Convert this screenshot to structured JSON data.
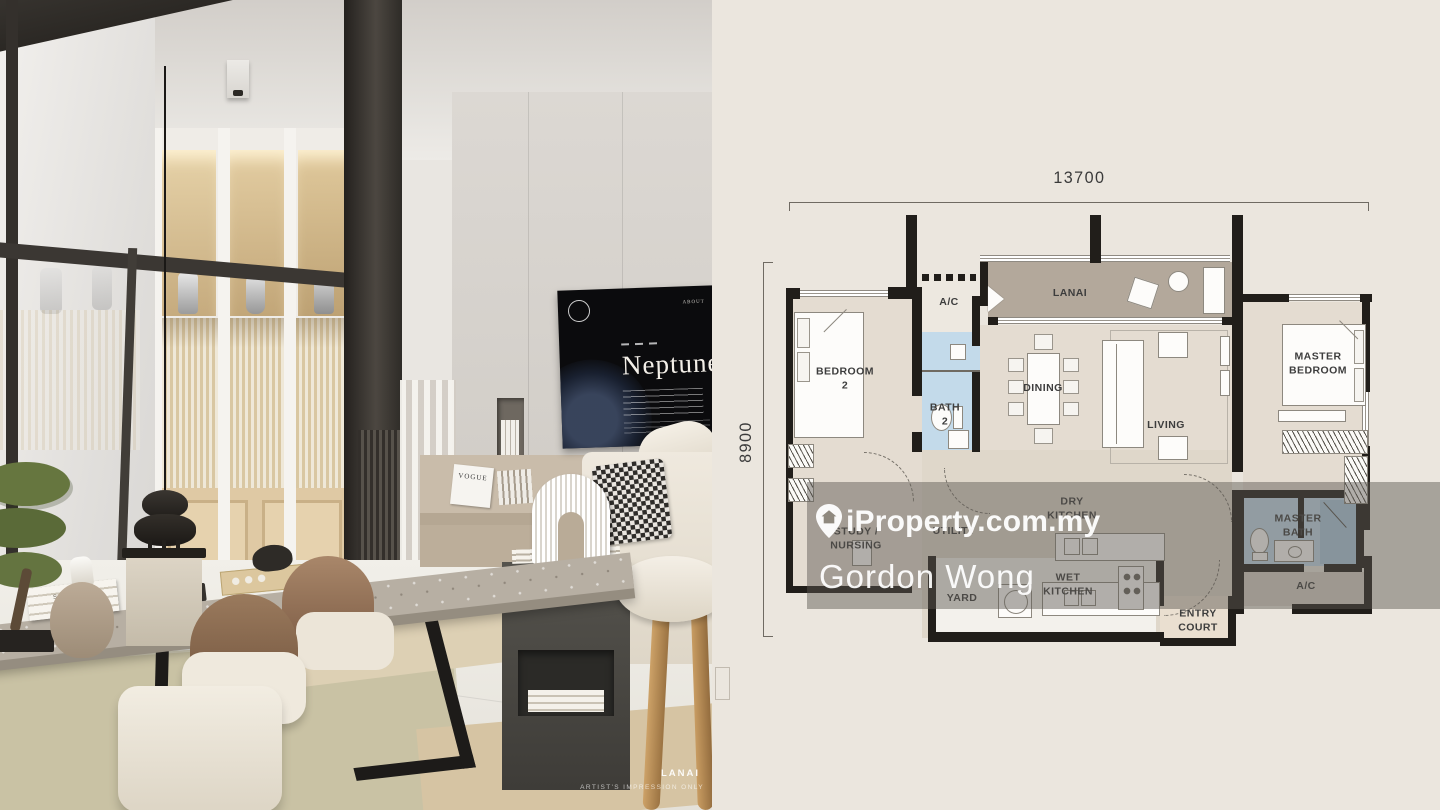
{
  "watermark": {
    "brand": "iProperty.com.my",
    "agent": "Gordon Wong",
    "pin_icon": "location-pin-icon",
    "band_color": "#5c574f"
  },
  "photo": {
    "caption": {
      "title": "LANAI",
      "subtitle": "ARTIST'S IMPRESSION ONLY"
    },
    "tv": {
      "title": "Neptune",
      "menu": "ABOUT"
    },
    "props": {
      "magazine": "VOGUE",
      "book": "SUMMER"
    }
  },
  "floorplan": {
    "dimensions": {
      "width_mm": "13700",
      "height_mm": "8900"
    },
    "rooms": {
      "bedroom2": {
        "line1": "BEDROOM",
        "line2": "2"
      },
      "ac_top": {
        "line1": "A/C"
      },
      "bath2": {
        "line1": "BATH",
        "line2": "2"
      },
      "lanai": {
        "line1": "LANAI"
      },
      "dining": {
        "line1": "DINING"
      },
      "living": {
        "line1": "LIVING"
      },
      "master_bedroom": {
        "line1": "MASTER",
        "line2": "BEDROOM"
      },
      "study": {
        "line1": "STUDY /",
        "line2": "NURSING"
      },
      "utility": {
        "line1": "UTILITY"
      },
      "dry_kitchen": {
        "line1": "DRY",
        "line2": "KITCHEN"
      },
      "wet_kitchen": {
        "line1": "WET",
        "line2": "KITCHEN"
      },
      "yard": {
        "line1": "YARD"
      },
      "entry_court": {
        "line1": "ENTRY",
        "line2": "COURT"
      },
      "master_bath": {
        "line1": "MASTER",
        "line2": "BATH"
      },
      "ac_right": {
        "line1": "A/C"
      }
    },
    "colors": {
      "background": "#EBE6DE",
      "floor": "#E4DCD1",
      "kitchen_floor": "#E0D8CC",
      "lanai": "#B3A89B",
      "bath": "#C3DAEA",
      "wall": "#211E1A",
      "label": "#3D3D3D"
    }
  }
}
